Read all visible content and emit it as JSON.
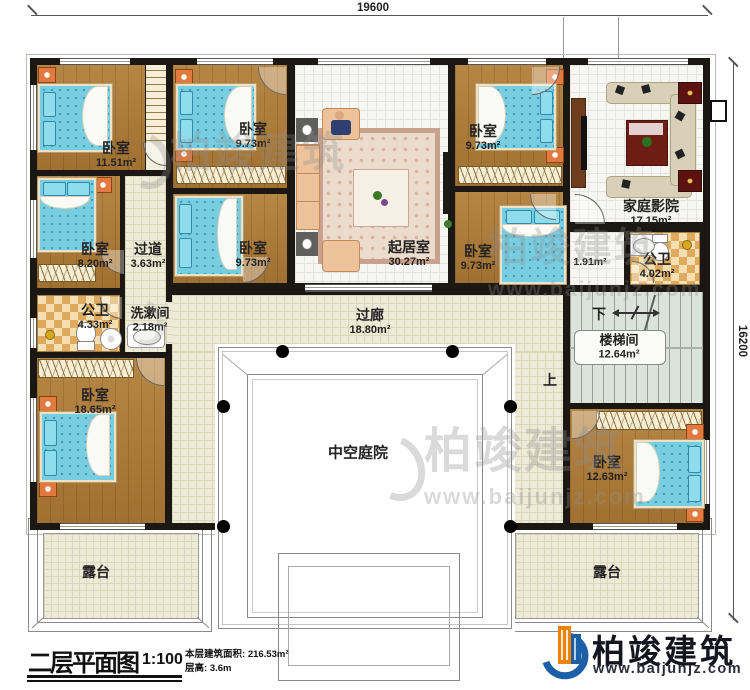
{
  "plan": {
    "dimensions": {
      "top": "19600",
      "right": "16200"
    },
    "rooms": {
      "bedroom_tl": {
        "name": "卧室",
        "area": "11.51m²"
      },
      "bedroom_tm": {
        "name": "卧室",
        "area": "9.73m²"
      },
      "living": {
        "name": "起居室",
        "area": "30.27m²"
      },
      "bedroom_tr": {
        "name": "卧室",
        "area": "9.73m²"
      },
      "theater": {
        "name": "家庭影院",
        "area": "17.15m²"
      },
      "bedroom_ml": {
        "name": "卧室",
        "area": "8.20m²"
      },
      "hallway": {
        "name": "过道",
        "area": "3.63m²"
      },
      "bedroom_mm": {
        "name": "卧室",
        "area": "9.73m²"
      },
      "bedroom_mr": {
        "name": "卧室",
        "area": "9.73m²"
      },
      "lobby": {
        "area": "1.91m²"
      },
      "bath_right": {
        "name": "公卫",
        "area": "4.02m²"
      },
      "bath_left": {
        "name": "公卫",
        "area": "4.33m²"
      },
      "washroom": {
        "name": "洗漱间",
        "area": "2.18m²"
      },
      "gallery": {
        "name": "过廊",
        "area": "18.80m²"
      },
      "stairwell": {
        "name": "楼梯间",
        "area": "12.64m²"
      },
      "bedroom_bl": {
        "name": "卧室",
        "area": "18.65m²"
      },
      "bedroom_br": {
        "name": "卧室",
        "area": "12.63m²"
      },
      "courtyard": {
        "name": "中空庭院"
      },
      "terrace_left": {
        "name": "露台"
      },
      "terrace_right": {
        "name": "露台"
      }
    },
    "stairs": {
      "down": "下",
      "up": "上"
    }
  },
  "title_block": {
    "title": "二层平面图",
    "scale": "1:100",
    "area_label": "本层建筑面积:",
    "area_value": "216.53m²",
    "height_label": "层高:",
    "height_value": "3.6m"
  },
  "brand": {
    "name": "柏竣建筑",
    "website": "www.baijunjz.com"
  },
  "watermark": {
    "text": "柏竣建筑",
    "website": "www.baijunjz.com"
  },
  "colors": {
    "wall": "#1b1712",
    "logo_blue": "#1b5fa8",
    "logo_orange": "#f08300",
    "bed_blue": "#79cde1"
  }
}
